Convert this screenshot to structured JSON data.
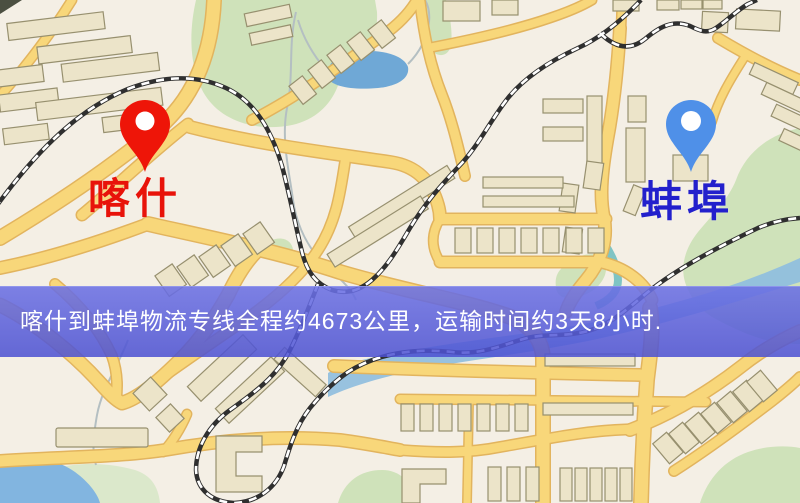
{
  "banner": {
    "text": "喀什到蚌埠物流专线全程约4673公里，运输时间约3天8小时.",
    "background_color": "#5358d5",
    "text_color": "#ffffff"
  },
  "route": {
    "origin": "喀什",
    "destination": "蚌埠",
    "distance": "约4673公里",
    "duration": "约3天8小时"
  },
  "markers": {
    "origin": {
      "label": "喀什",
      "icon": "map-pin",
      "pin_color": "#ee1508",
      "label_color": "#e8130a"
    },
    "destination": {
      "label": "蚌埠",
      "icon": "map-pin",
      "pin_color": "#4f90e8",
      "label_color": "#2320cc"
    }
  },
  "map_theme": {
    "background": "#f4efe5",
    "road_fill": "#f8d77a",
    "road_casing": "#e2b45e",
    "building_fill": "#ece4c9",
    "building_stroke": "#97906f",
    "park": "#cfe2ba",
    "water": "#6fa8d6",
    "railway": "#2f2f2f"
  }
}
